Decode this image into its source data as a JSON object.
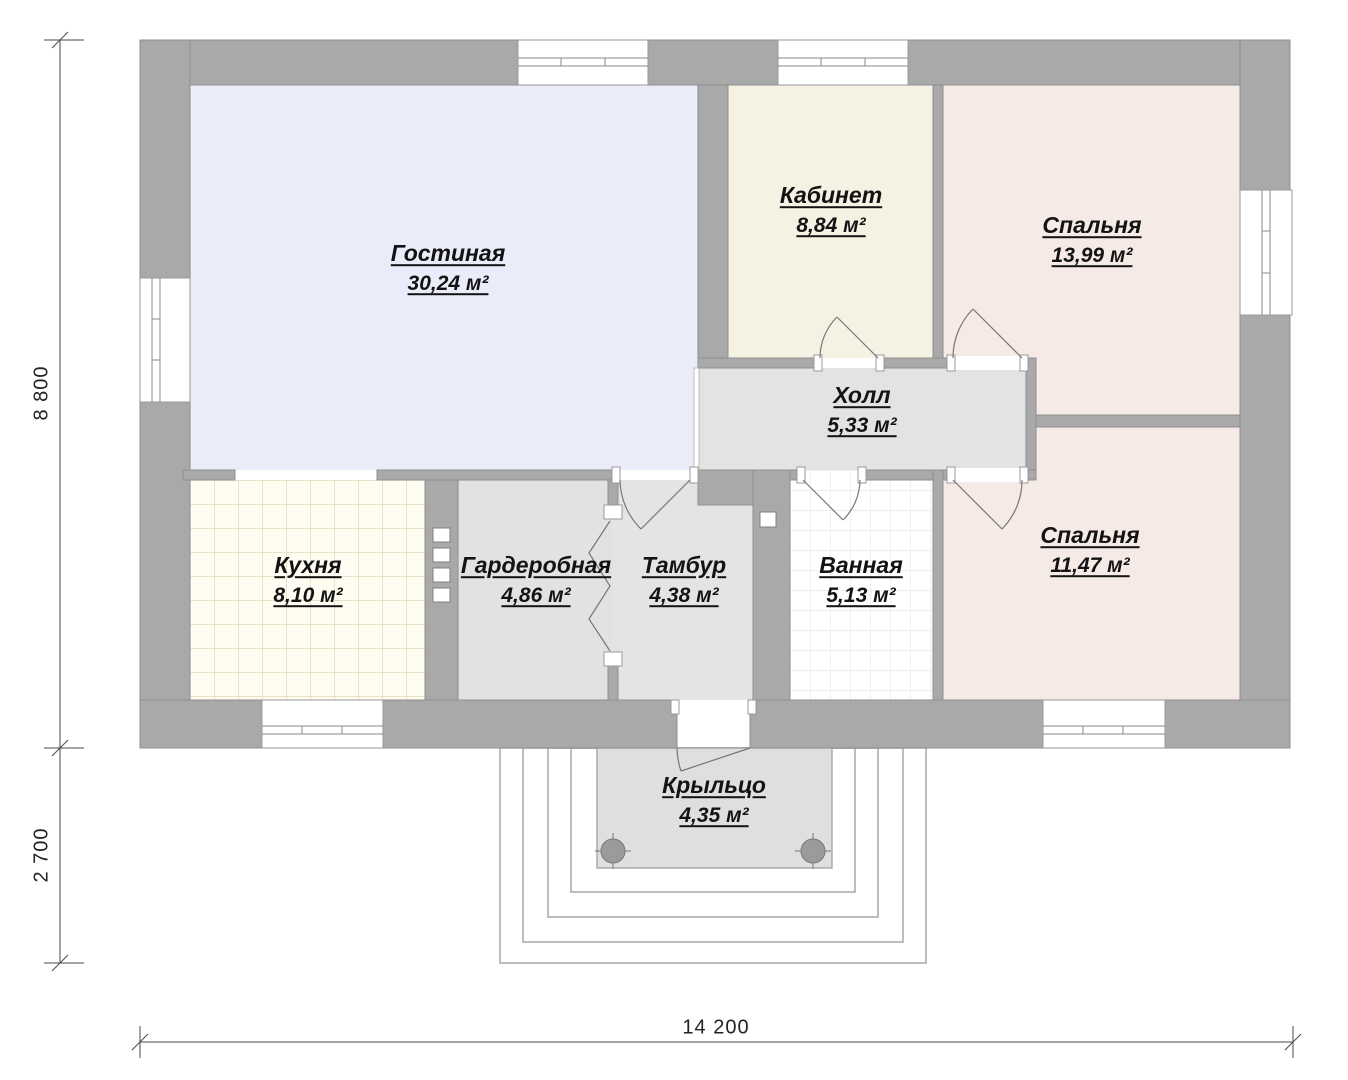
{
  "rooms": {
    "living": {
      "name": "Гостиная",
      "area": "30,24 м²"
    },
    "office": {
      "name": "Кабинет",
      "area": "8,84 м²"
    },
    "bedroom1": {
      "name": "Спальня",
      "area": "13,99 м²"
    },
    "hall": {
      "name": "Холл",
      "area": "5,33 м²"
    },
    "kitchen": {
      "name": "Кухня",
      "area": "8,10 м²"
    },
    "wardrobe": {
      "name": "Гардеробная",
      "area": "4,86 м²"
    },
    "vestibule": {
      "name": "Тамбур",
      "area": "4,38 м²"
    },
    "bathroom": {
      "name": "Ванная",
      "area": "5,13 м²"
    },
    "bedroom2": {
      "name": "Спальня",
      "area": "11,47 м²"
    },
    "porch": {
      "name": "Крыльцо",
      "area": "4,35 м²"
    }
  },
  "dimensions": {
    "overall_width": "14 200",
    "main_depth": "8 800",
    "porch_depth": "2 700"
  },
  "colors": {
    "wall": "#a9a9a9",
    "living": "#eaecfa",
    "office": "#f5f2e3",
    "bedroom": "#f6eae6",
    "hall": "#e3e3e3",
    "wardrobe": "#e2e2e2",
    "vestibule": "#e4e4e4",
    "kitchen": "#fffdf2",
    "kitchen_grid": "#d8d4ad",
    "bathroom": "#ffffff",
    "bathroom_grid": "#e2e6ea",
    "porch": "#dfdfdf",
    "column": "#9b9b9b"
  }
}
